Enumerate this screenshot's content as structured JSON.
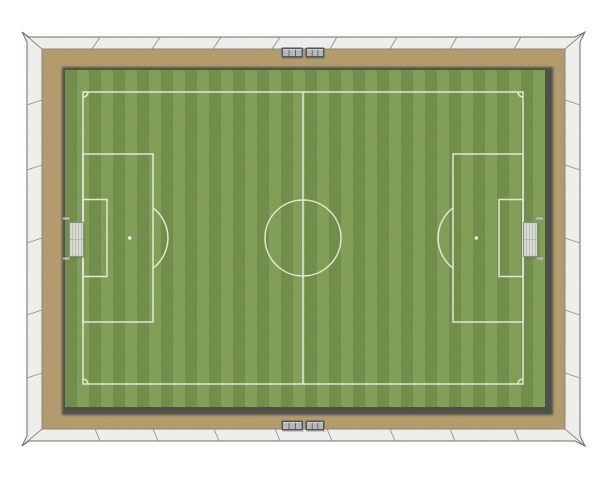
{
  "scene": {
    "description": "Top-down render of an empty soccer football pitch inside a white stadium wall with tan perimeter ground, striped grass, two goals and team benches",
    "background_color": "#ffffff"
  },
  "wall": {
    "fill": "#f0f0ed",
    "edge": "#6d6d66",
    "seam": "#90908a"
  },
  "ground": {
    "fill": "#b29a6a",
    "edge": "#87877e"
  },
  "pitch": {
    "shadow": "#4f5148",
    "grass_dark": "#6a8a40",
    "grass_light": "#7c9c4e",
    "stripe_count": 40,
    "stripe_width": 12,
    "x": 65,
    "y": 70,
    "width": 480,
    "height": 337,
    "line_color": "#eff3ea"
  },
  "markings": {
    "items": [
      "touchlines",
      "halfway-line",
      "center-circle",
      "penalty-area-left",
      "penalty-area-right",
      "goal-area-left",
      "goal-area-right",
      "penalty-arc-left",
      "penalty-arc-right",
      "penalty-spot-left",
      "penalty-spot-right",
      "corner-arcs"
    ]
  },
  "goals": {
    "fill": "#e3e5e1",
    "frame": "#8a8c86",
    "net": "#a9aba3",
    "support": "#c2c3bd",
    "count": 2
  },
  "benches": {
    "frame": "#53555a",
    "panel": "#b5b8bb",
    "highlight": "#d8dadc",
    "count": 4,
    "panels_per_bench": 3
  }
}
